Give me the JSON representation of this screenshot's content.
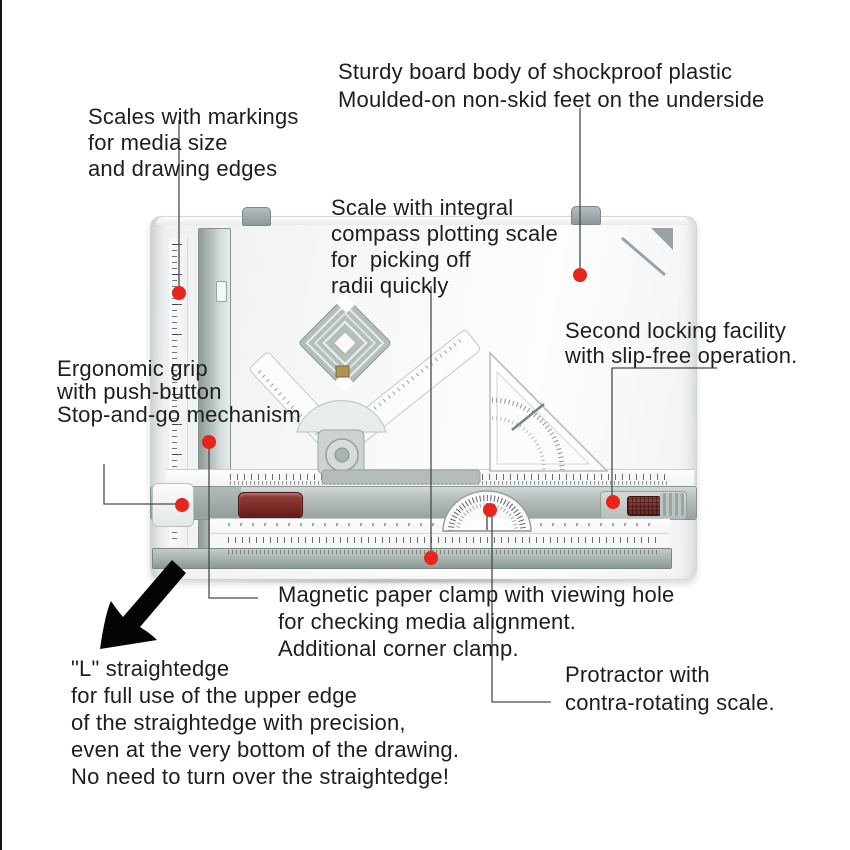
{
  "figure": {
    "type": "annotated-product-diagram",
    "subject": "A3 drawing board with parallel straightedge, protractor and set squares"
  },
  "callouts": {
    "scales": {
      "lines": [
        "Scales with markings",
        "for media size",
        "and drawing edges"
      ]
    },
    "sturdy": {
      "lines": [
        "Sturdy board body of shockproof plastic",
        "Moulded-on non-skid feet on the underside"
      ]
    },
    "integral": {
      "lines": [
        "Scale with integral",
        "compass plotting scale",
        "for  picking off",
        "radii quickly"
      ]
    },
    "locking": {
      "lines": [
        "Second locking facility",
        "with slip-free operation."
      ]
    },
    "ergonomic": {
      "lines": [
        "Ergonomic grip",
        "with push-button",
        "Stop-and-go mechanism"
      ]
    },
    "magnetic": {
      "lines": [
        "Magnetic paper clamp with viewing hole",
        "for checking media alignment.",
        "Additional corner clamp."
      ]
    },
    "straightedge": {
      "lines": [
        "\"L\" straightedge",
        "for full use of the upper edge",
        "of the straightedge with precision,",
        "even at the very bottom of the drawing.",
        "No need to turn over the straightedge!"
      ]
    },
    "protractor": {
      "lines": [
        "Protractor with",
        "contra-rotating scale."
      ]
    }
  },
  "colors": {
    "marker": "#e8251d",
    "leader": "#4a4a4a",
    "arrow": "#050505",
    "rail": "#a7b1ae",
    "handle": "#7d2c28",
    "board": "#f6f7f9"
  }
}
